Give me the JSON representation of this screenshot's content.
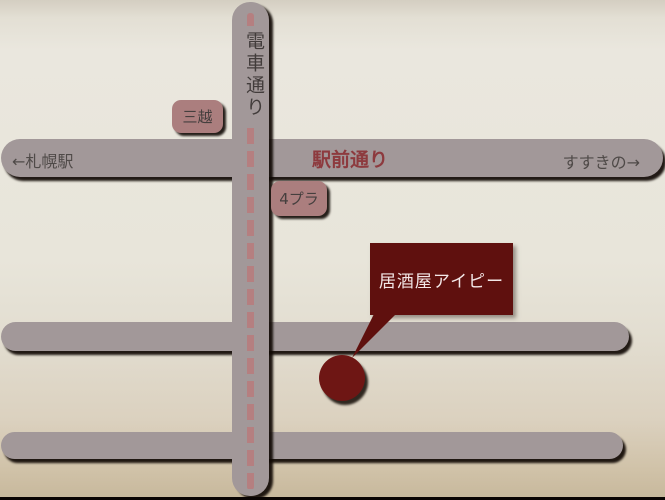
{
  "labels": {
    "tram_street": "電車通り",
    "station_street": "駅前通り",
    "to_sapporo": "←札幌駅",
    "to_susukino": "すすきの→",
    "mitsukoshi": "三越",
    "four_pla": "4プラ",
    "venue": "居酒屋アイピー"
  },
  "colors": {
    "road": "#a29899",
    "tram_dash": "#b57f80",
    "landmark_box": "#ab7e7e",
    "landmark_text": "#453f3e",
    "street_text": "#4f4a48",
    "station_street_text": "#8d3a3e",
    "venue_callout": "#5f100e",
    "venue_marker": "#6e1614",
    "background_top": "#d4cec1",
    "background_middle": "#e8e5da",
    "background_bottom": "#c8b99d",
    "bottom_border": "#0a0503"
  }
}
